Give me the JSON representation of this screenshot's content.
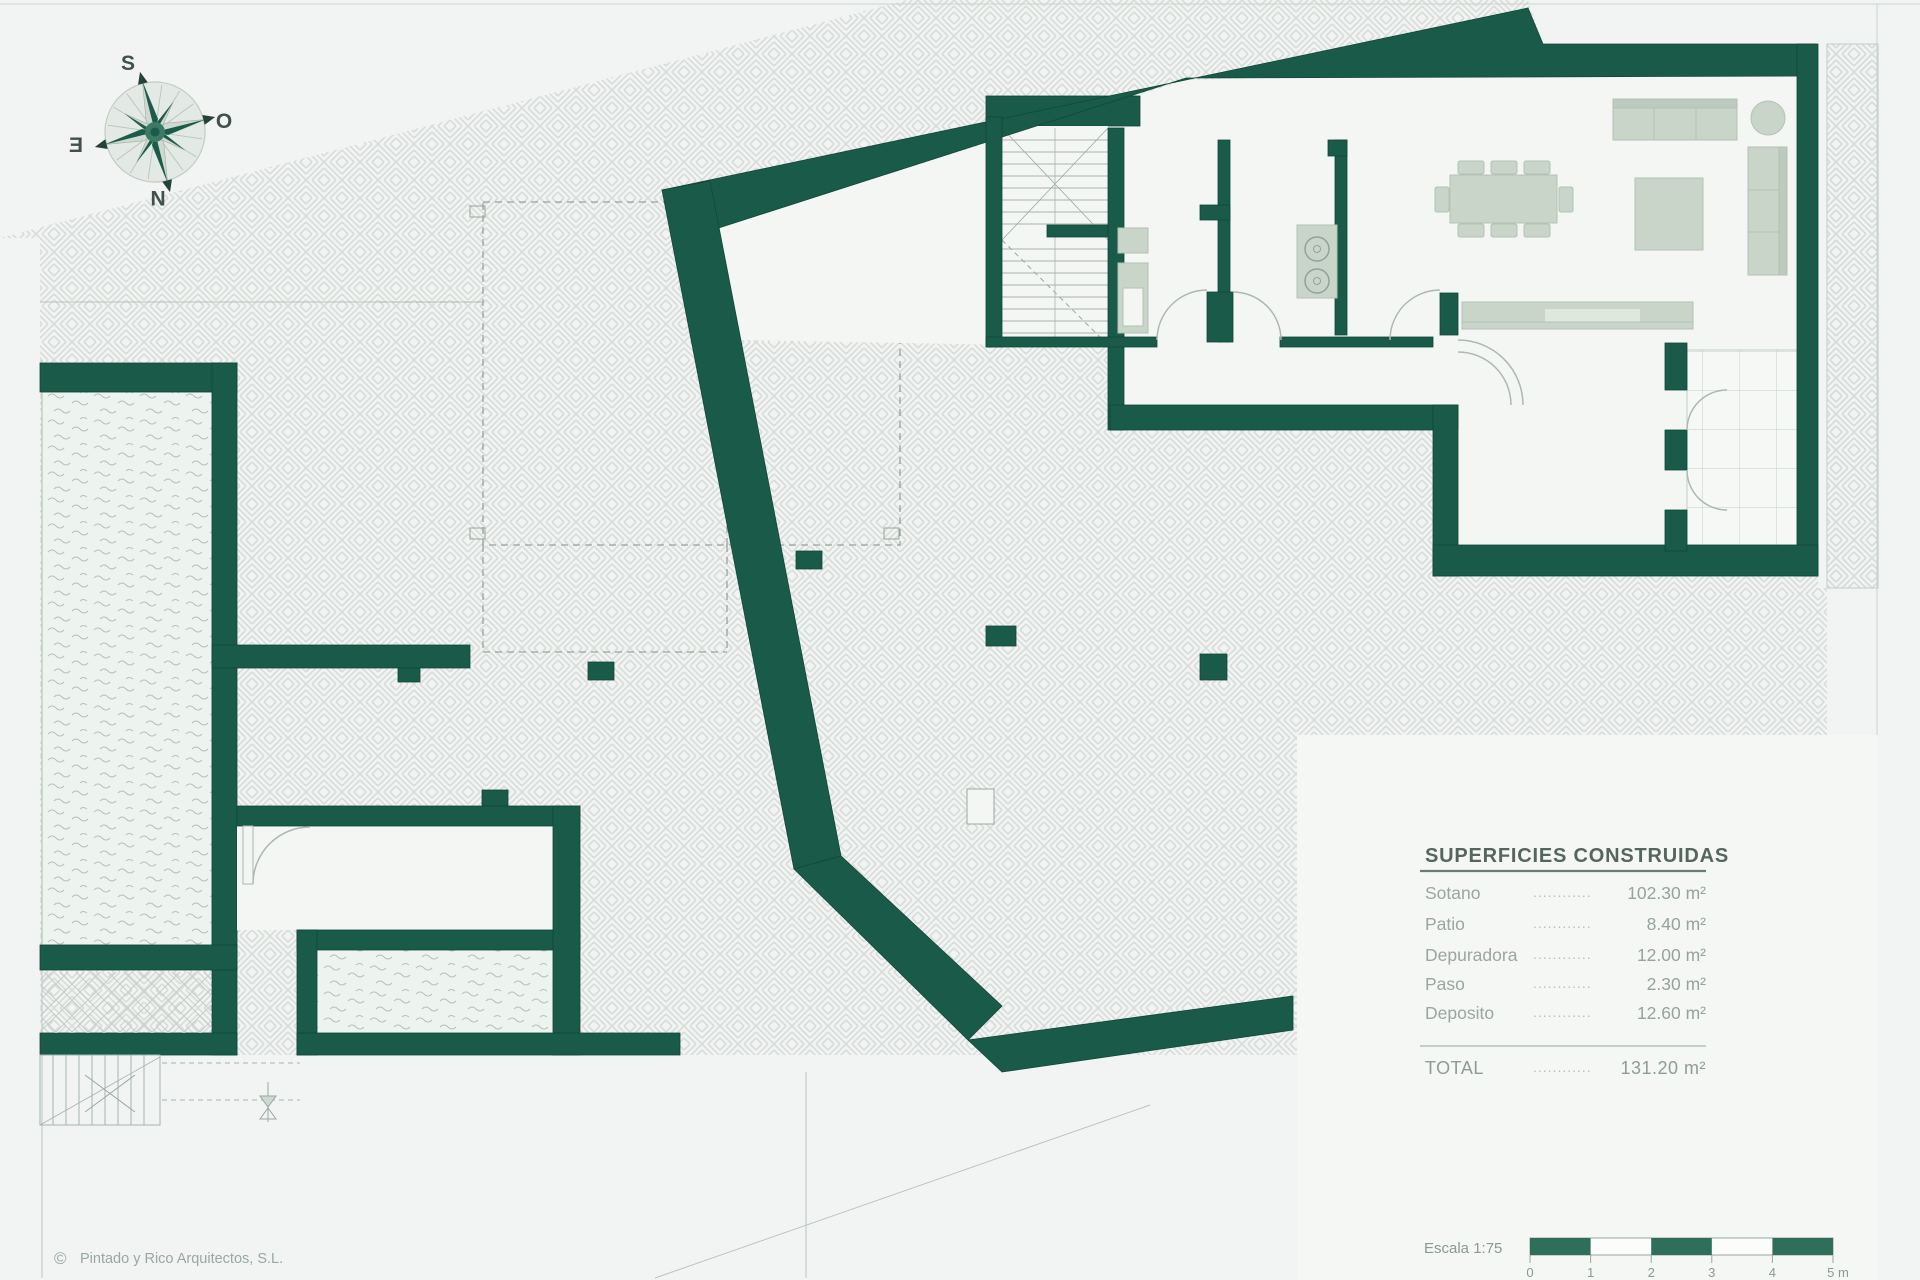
{
  "title_block": {
    "header": "SUPERFICIES CONSTRUIDAS",
    "rows": [
      {
        "label": "Sotano",
        "leader": "............",
        "value": "102.30 m²"
      },
      {
        "label": "Patio",
        "leader": "............",
        "value": "8.40 m²"
      },
      {
        "label": "Depuradora",
        "leader": "............",
        "value": "12.00 m²"
      },
      {
        "label": "Paso",
        "leader": "............",
        "value": "2.30 m²"
      },
      {
        "label": "Deposito",
        "leader": "............",
        "value": "12.60 m²"
      }
    ],
    "total": {
      "label": "TOTAL",
      "leader": "............",
      "value": "131.20 m²"
    }
  },
  "scale": {
    "label": "Escala 1:75",
    "ticks": [
      "0",
      "1",
      "2",
      "3",
      "4",
      "5 m"
    ]
  },
  "compass": {
    "top": "S",
    "right": "O",
    "bottom": "N",
    "left": "E"
  },
  "footer": {
    "copyright_symbol": "©",
    "copyright": "Pintado y Rico Arquitectos, S.L."
  },
  "colors": {
    "wall_green": "#1a5a49",
    "scale_green": "#2f6e5a",
    "background": "#f1f4f2"
  }
}
